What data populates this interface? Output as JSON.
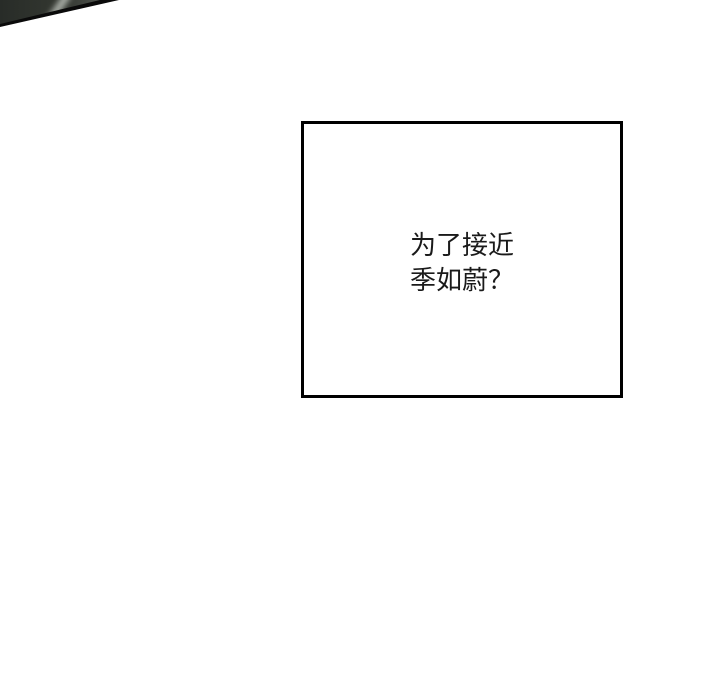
{
  "corner_artwork": {
    "fill_color": "#31352f",
    "highlight_color": "#c8cdc6",
    "outline_color": "#0a0a0a"
  },
  "dialogue_panel": {
    "background_color": "#ffffff",
    "border_color": "#000000",
    "text_color": "#1a1a1a",
    "lines": [
      "为了接近",
      "季如蔚？"
    ]
  }
}
